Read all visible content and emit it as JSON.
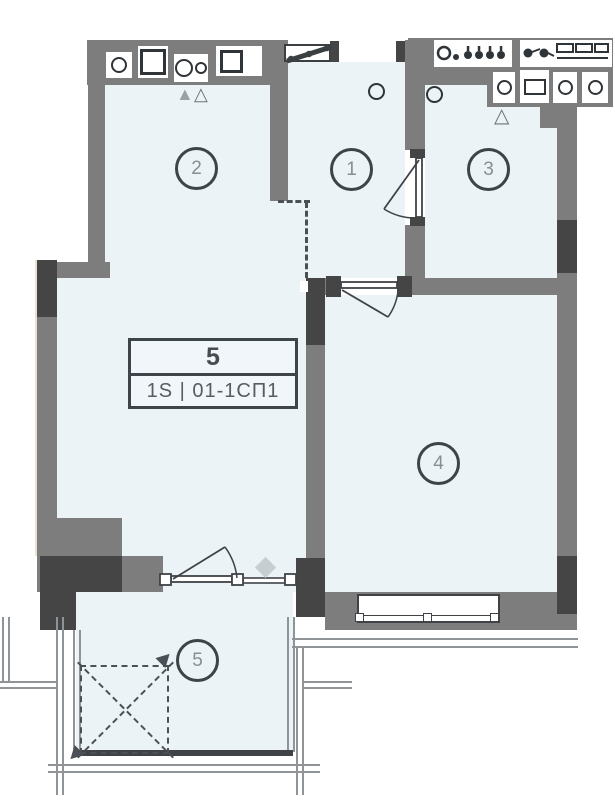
{
  "floorplan": {
    "unit_badge": {
      "number": "5",
      "code": "1S | 01-1СП1"
    },
    "rooms": [
      {
        "id": "room-1",
        "label": "1"
      },
      {
        "id": "room-2",
        "label": "2"
      },
      {
        "id": "room-3",
        "label": "3"
      },
      {
        "id": "room-4",
        "label": "4"
      },
      {
        "id": "room-5",
        "label": "5"
      }
    ],
    "symbols": {
      "vent_filled": "▲",
      "vent_outline": "△"
    },
    "colors": {
      "floor": "#ecf3f7",
      "wall": "#7d7d7d",
      "wall_dark": "#454545",
      "line_dark": "#3f4347",
      "marker_ring": "#3d4347",
      "marker_text": "#878e93",
      "thin_line": "#8e9497",
      "diamond": "#c7ced2"
    }
  }
}
